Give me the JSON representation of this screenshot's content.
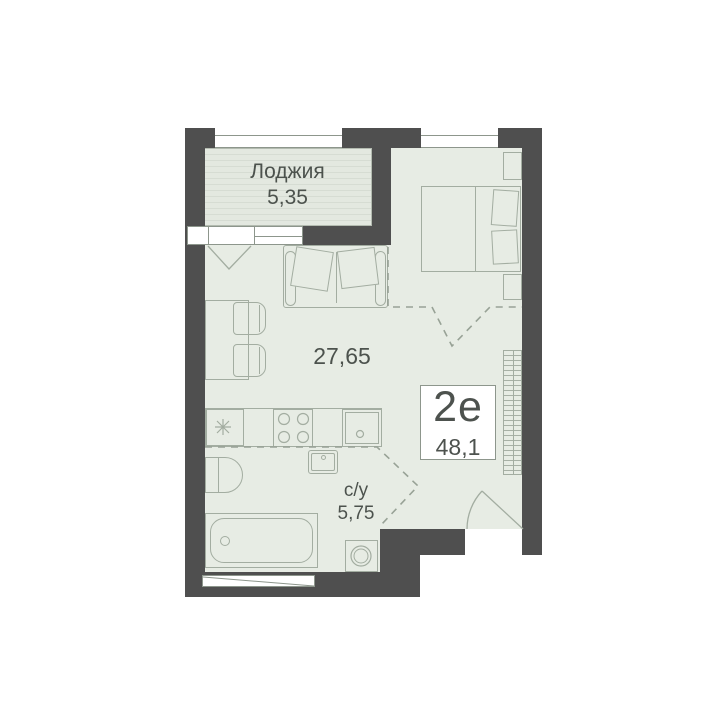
{
  "plan": {
    "loggia": {
      "name": "Лоджия",
      "area": "5,35"
    },
    "living": {
      "area": "27,65"
    },
    "bathroom": {
      "name": "с/у",
      "area": "5,75"
    },
    "unit": {
      "type": "2е",
      "total_area": "48,1"
    }
  },
  "colors": {
    "wall": "#4f4f4f",
    "floor": "#e7ece4",
    "furniture-line": "#a3ada1",
    "text": "#4c524d",
    "dash": "#98a296",
    "loggia-base": "#e3e8e0",
    "loggia-stripe": "#d6dcd3",
    "frame": "#8d968c",
    "label-bg": "#ffffff"
  }
}
